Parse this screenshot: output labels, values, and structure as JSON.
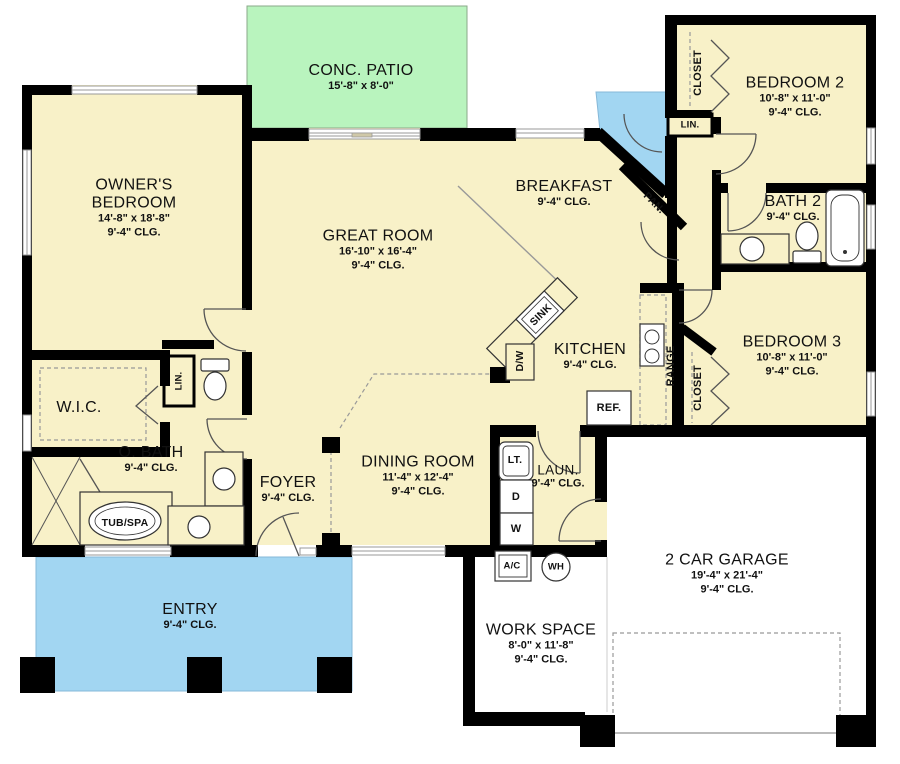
{
  "colors": {
    "wall": "#000000",
    "interior": "#f8f1c8",
    "patio": "#b9f4be",
    "porch": "#a2d6f2",
    "garage": "#ffffff"
  },
  "rooms": {
    "patio": {
      "name": "CONC. PATIO",
      "dims": "15'-8\" x 8'-0\""
    },
    "owners": {
      "name": "OWNER'S BEDROOM",
      "dims": "14'-8\" x 18'-8\"",
      "clg": "9'-4\" CLG."
    },
    "great": {
      "name": "GREAT ROOM",
      "dims": "16'-10\" x 16'-4\"",
      "clg": "9'-4\" CLG."
    },
    "breakfast": {
      "name": "BREAKFAST",
      "clg": "9'-4\" CLG."
    },
    "bedroom2": {
      "name": "BEDROOM 2",
      "dims": "10'-8\" x 11'-0\"",
      "clg": "9'-4\" CLG."
    },
    "bath2": {
      "name": "BATH 2",
      "clg": "9'-4\" CLG."
    },
    "bedroom3": {
      "name": "BEDROOM 3",
      "dims": "10'-8\" x 11'-0\"",
      "clg": "9'-4\" CLG."
    },
    "kitchen": {
      "name": "KITCHEN",
      "clg": "9'-4\" CLG."
    },
    "wic": {
      "name": "W.I.C."
    },
    "obath": {
      "name": "O. BATH",
      "clg": "9'-4\" CLG."
    },
    "foyer": {
      "name": "FOYER",
      "clg": "9'-4\" CLG."
    },
    "dining": {
      "name": "DINING ROOM",
      "dims": "11'-4\" x 12'-4\"",
      "clg": "9'-4\" CLG."
    },
    "laundry": {
      "name": "LAUN.",
      "clg": "9'-4\" CLG."
    },
    "entry": {
      "name": "ENTRY",
      "clg": "9'-4\" CLG."
    },
    "garage": {
      "name": "2 CAR GARAGE",
      "dims": "19'-4\" x 21'-4\"",
      "clg": "9'-4\" CLG."
    },
    "workspace": {
      "name": "WORK SPACE",
      "dims": "8'-0\" x 11'-8\"",
      "clg": "9'-4\" CLG."
    }
  },
  "fixtures": {
    "closet2": "CLOSET",
    "lin2": "LIN.",
    "closet3": "CLOSET",
    "lin_obath": "LIN.",
    "pantry": "PAN.",
    "sink": "SINK",
    "dishwasher": "D/W",
    "range": "RANGE",
    "refrigerator": "REF.",
    "laundry_tub": "LT.",
    "dryer": "D",
    "washer": "W",
    "ac": "A/C",
    "water_heater": "WH",
    "tub_spa": "TUB/SPA"
  }
}
